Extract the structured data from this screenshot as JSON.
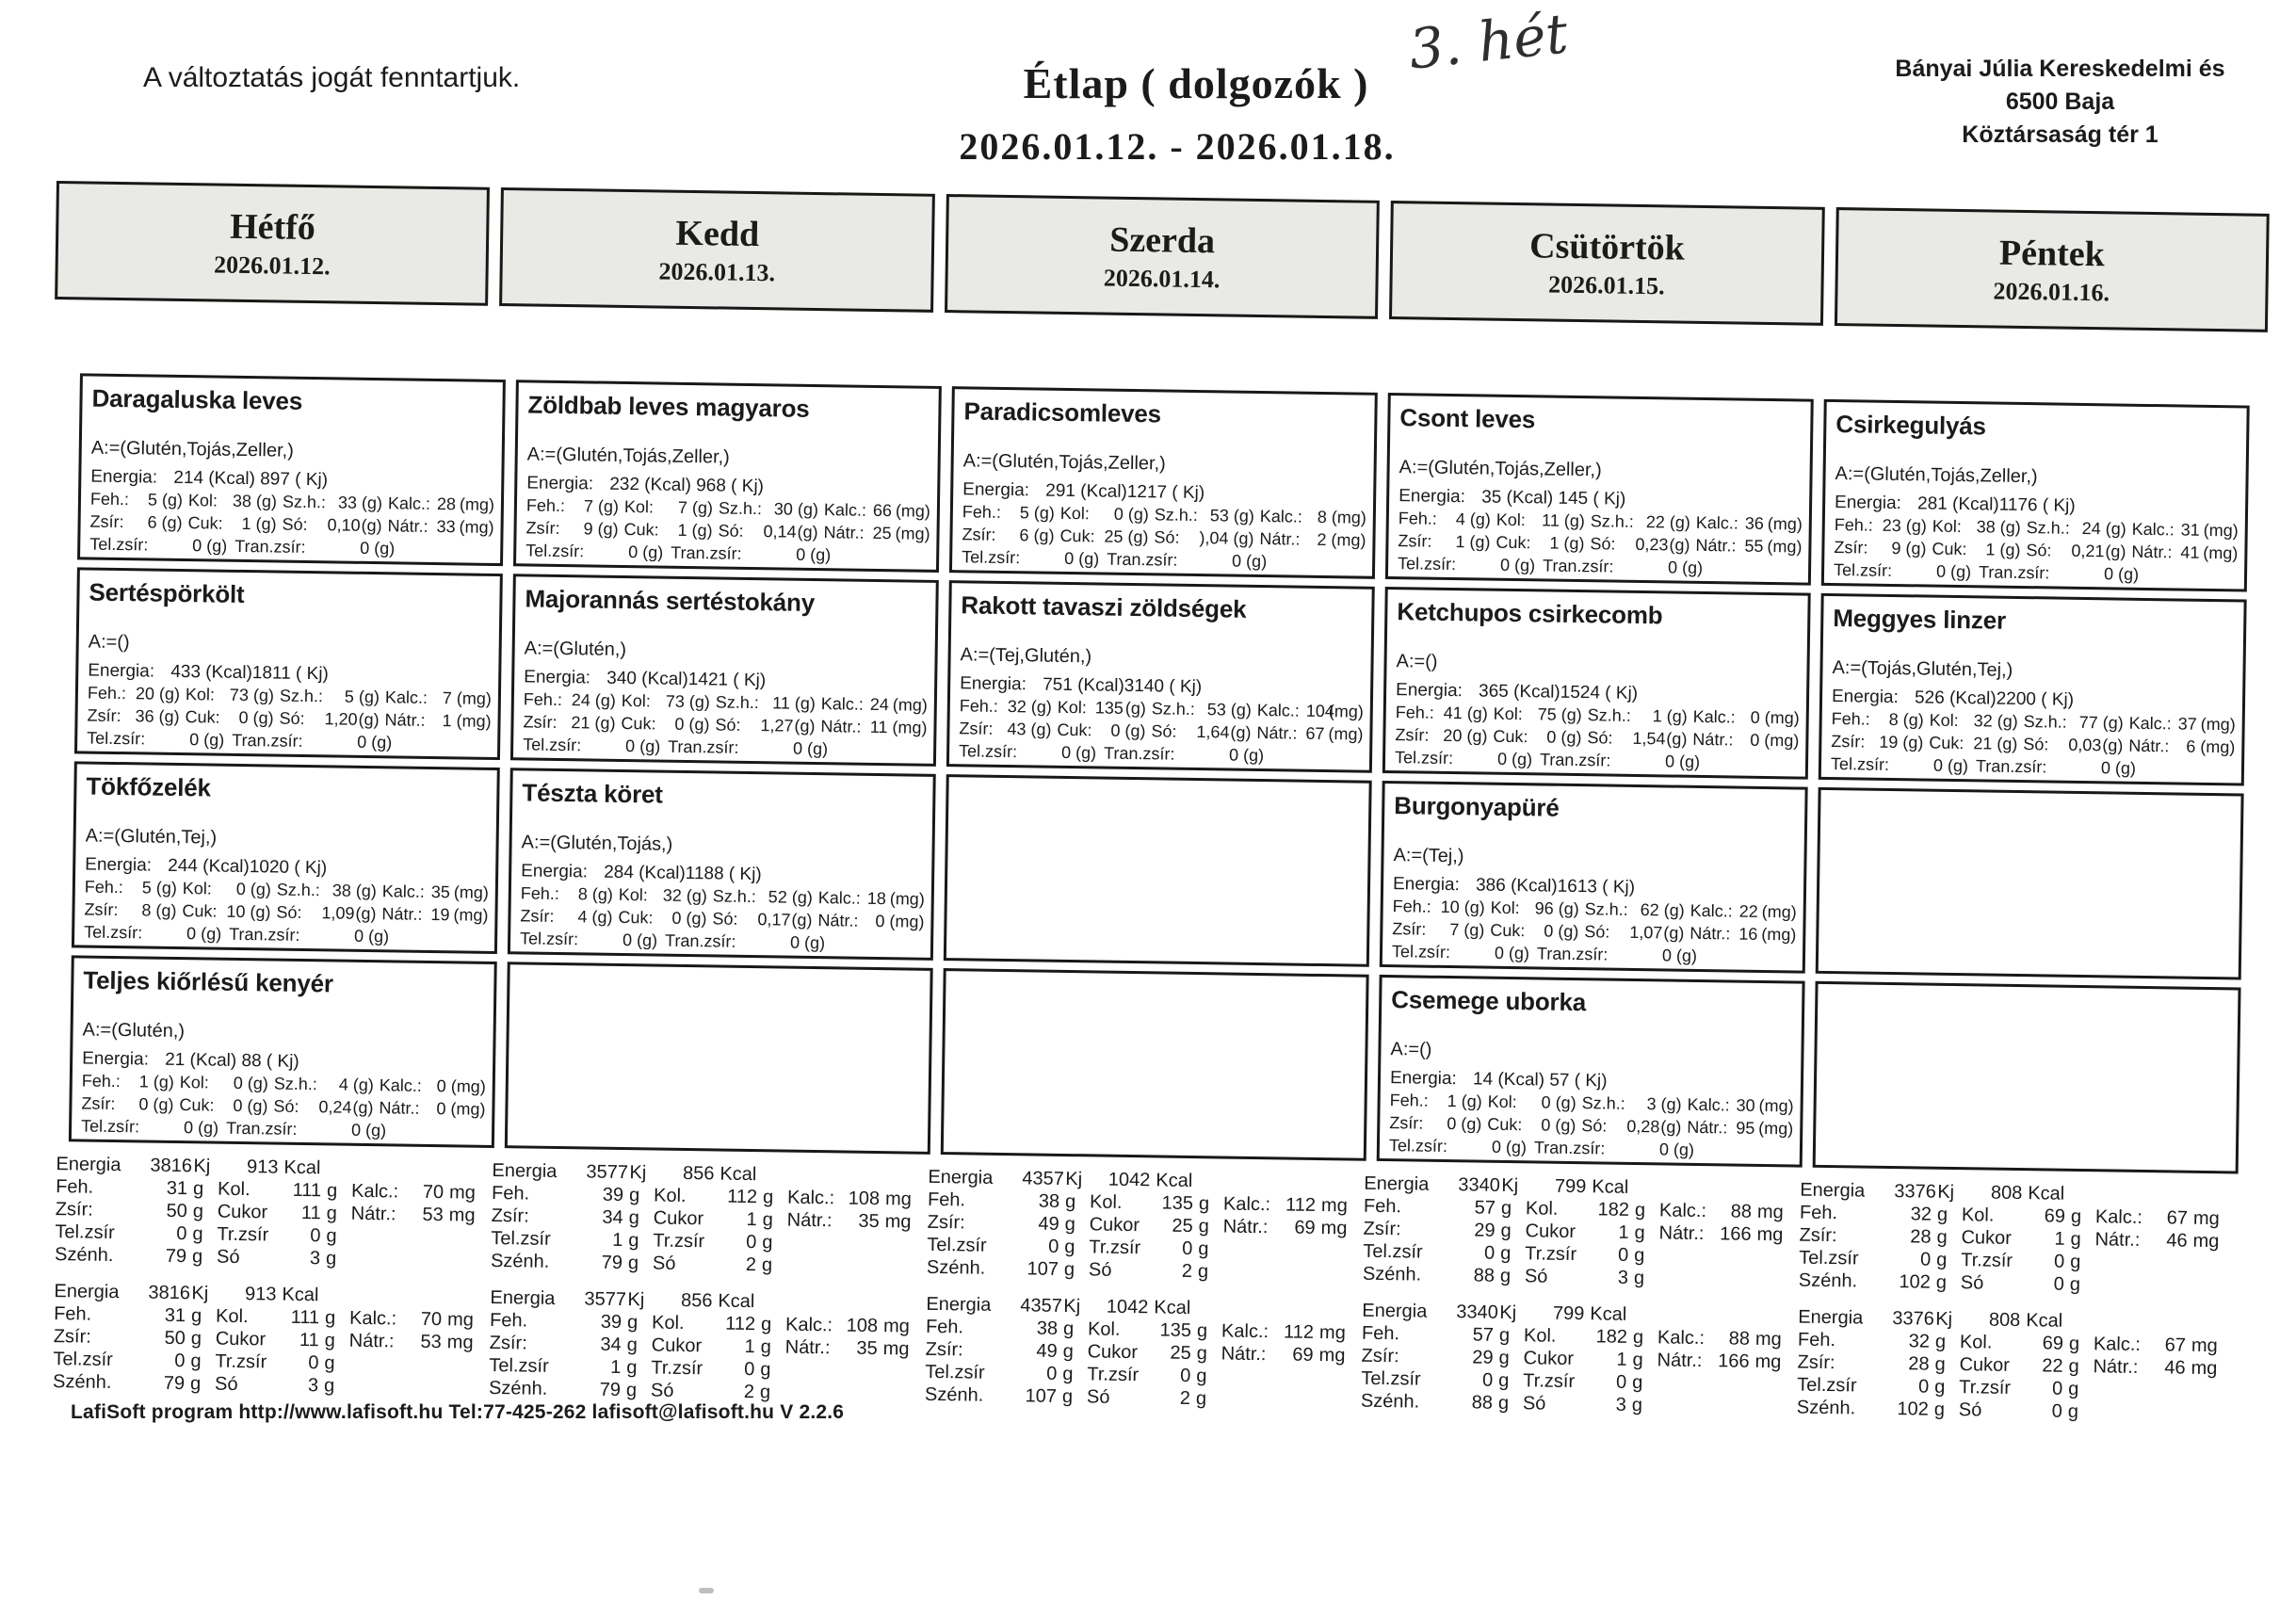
{
  "header": {
    "disclaimer": "A változtatás jogát fenntartjuk.",
    "title": "Étlap ( dolgozók )",
    "date_range": "2026.01.12. - 2026.01.18.",
    "handwritten_note": "3. hét",
    "company_line1": "Bányai Júlia Kereskedelmi és",
    "company_line2": "6500 Baja",
    "company_line3": "Köztársaság tér 1"
  },
  "labels": {
    "card": {
      "energia": "Energia:",
      "feh": "Feh.:",
      "kol": "Kol:",
      "szh": "Sz.h.:",
      "kalc": "Kalc.:",
      "zsir": "Zsír:",
      "cuk": "Cuk:",
      "so": "Só:",
      "natr": "Nátr.:",
      "telzsir": "Tel.zsír:",
      "tranzsir": "Tran.zsír:",
      "g": "(g)",
      "mg": "(mg)"
    },
    "summary": {
      "energia": "Energia",
      "kj": "Kj",
      "kcal": "Kcal",
      "feh": "Feh.",
      "kol": "Kol.",
      "kalc": "Kalc.:",
      "zsir": "Zsír:",
      "cukor": "Cukor",
      "natr": "Nátr.:",
      "telzsir": "Tel.zsír",
      "trzsir": "Tr.zsír",
      "szenh": "Szénh.",
      "so": "Só",
      "g": "g",
      "mg": "mg"
    }
  },
  "days": [
    {
      "name": "Hétfő",
      "date": "2026.01.12.",
      "meals": [
        {
          "title": "Daragaluska leves",
          "allergens": "A:=(Glutén,Tojás,Zeller,)",
          "energia": "214 (Kcal) 897 ( Kj)",
          "feh": "5",
          "kol": "38",
          "szh": "33",
          "kalc": "28",
          "zsir": "6",
          "cuk": "1",
          "so": "0,10",
          "natr": "33",
          "telzsir": "0",
          "tranzsir": "0"
        },
        {
          "title": "Sertéspörkölt",
          "allergens": "A:=()",
          "energia": "433 (Kcal)1811 ( Kj)",
          "feh": "20",
          "kol": "73",
          "szh": "5",
          "kalc": "7",
          "zsir": "36",
          "cuk": "0",
          "so": "1,20",
          "natr": "1",
          "telzsir": "0",
          "tranzsir": "0"
        },
        {
          "title": "Tökfőzelék",
          "allergens": "A:=(Glutén,Tej,)",
          "energia": "244 (Kcal)1020 ( Kj)",
          "feh": "5",
          "kol": "0",
          "szh": "38",
          "kalc": "35",
          "zsir": "8",
          "cuk": "10",
          "so": "1,09",
          "natr": "19",
          "telzsir": "0",
          "tranzsir": "0"
        },
        {
          "title": "Teljes kiőrlésű kenyér",
          "allergens": "A:=(Glutén,)",
          "energia": "21 (Kcal)  88 ( Kj)",
          "feh": "1",
          "kol": "0",
          "szh": "4",
          "kalc": "0",
          "zsir": "0",
          "cuk": "0",
          "so": "0,24",
          "natr": "0",
          "telzsir": "0",
          "tranzsir": "0"
        }
      ],
      "summaries": [
        {
          "kj": "3816",
          "kcal": "913",
          "feh": "31",
          "kol": "111",
          "kalc": "70",
          "zsir": "50",
          "cukor": "11",
          "natr": "53",
          "telzsir": "0",
          "trzsir": "0",
          "szenh": "79",
          "so": "3"
        },
        {
          "kj": "3816",
          "kcal": "913",
          "feh": "31",
          "kol": "111",
          "kalc": "70",
          "zsir": "50",
          "cukor": "11",
          "natr": "53",
          "telzsir": "0",
          "trzsir": "0",
          "szenh": "79",
          "so": "3"
        }
      ]
    },
    {
      "name": "Kedd",
      "date": "2026.01.13.",
      "meals": [
        {
          "title": "Zöldbab leves magyaros",
          "allergens": "A:=(Glutén,Tojás,Zeller,)",
          "energia": "232 (Kcal) 968 ( Kj)",
          "feh": "7",
          "kol": "7",
          "szh": "30",
          "kalc": "66",
          "zsir": "9",
          "cuk": "1",
          "so": "0,14",
          "natr": "25",
          "telzsir": "0",
          "tranzsir": "0"
        },
        {
          "title": "Majorannás sertéstokány",
          "allergens": "A:=(Glutén,)",
          "energia": "340 (Kcal)1421 ( Kj)",
          "feh": "24",
          "kol": "73",
          "szh": "11",
          "kalc": "24",
          "zsir": "21",
          "cuk": "0",
          "so": "1,27",
          "natr": "11",
          "telzsir": "0",
          "tranzsir": "0"
        },
        {
          "title": "Tészta köret",
          "allergens": "A:=(Glutén,Tojás,)",
          "energia": "284 (Kcal)1188 ( Kj)",
          "feh": "8",
          "kol": "32",
          "szh": "52",
          "kalc": "18",
          "zsir": "4",
          "cuk": "0",
          "so": "0,17",
          "natr": "0",
          "telzsir": "0",
          "tranzsir": "0"
        },
        null
      ],
      "summaries": [
        {
          "kj": "3577",
          "kcal": "856",
          "feh": "39",
          "kol": "112",
          "kalc": "108",
          "zsir": "34",
          "cukor": "1",
          "natr": "35",
          "telzsir": "1",
          "trzsir": "0",
          "szenh": "79",
          "so": "2"
        },
        {
          "kj": "3577",
          "kcal": "856",
          "feh": "39",
          "kol": "112",
          "kalc": "108",
          "zsir": "34",
          "cukor": "1",
          "natr": "35",
          "telzsir": "1",
          "trzsir": "0",
          "szenh": "79",
          "so": "2"
        }
      ]
    },
    {
      "name": "Szerda",
      "date": "2026.01.14.",
      "meals": [
        {
          "title": "Paradicsomleves",
          "allergens": "A:=(Glutén,Tojás,Zeller,)",
          "energia": "291 (Kcal)1217 ( Kj)",
          "feh": "5",
          "kol": "0",
          "szh": "53",
          "kalc": "8",
          "zsir": "6",
          "cuk": "25",
          "so": "),04",
          "natr": "2",
          "telzsir": "0",
          "tranzsir": "0"
        },
        {
          "title": "Rakott tavaszi zöldségek",
          "allergens": "A:=(Tej,Glutén,)",
          "energia": "751 (Kcal)3140 ( Kj)",
          "feh": "32",
          "kol": "135",
          "szh": "53",
          "kalc": "104",
          "zsir": "43",
          "cuk": "0",
          "so": "1,64",
          "natr": "67",
          "telzsir": "0",
          "tranzsir": "0"
        },
        null,
        null
      ],
      "summaries": [
        {
          "kj": "4357",
          "kcal": "1042",
          "feh": "38",
          "kol": "135",
          "kalc": "112",
          "zsir": "49",
          "cukor": "25",
          "natr": "69",
          "telzsir": "0",
          "trzsir": "0",
          "szenh": "107",
          "so": "2"
        },
        {
          "kj": "4357",
          "kcal": "1042",
          "feh": "38",
          "kol": "135",
          "kalc": "112",
          "zsir": "49",
          "cukor": "25",
          "natr": "69",
          "telzsir": "0",
          "trzsir": "0",
          "szenh": "107",
          "so": "2"
        }
      ]
    },
    {
      "name": "Csütörtök",
      "date": "2026.01.15.",
      "meals": [
        {
          "title": "Csont leves",
          "allergens": "A:=(Glutén,Tojás,Zeller,)",
          "energia": "35 (Kcal) 145 ( Kj)",
          "feh": "4",
          "kol": "11",
          "szh": "22",
          "kalc": "36",
          "zsir": "1",
          "cuk": "1",
          "so": "0,23",
          "natr": "55",
          "telzsir": "0",
          "tranzsir": "0"
        },
        {
          "title": "Ketchupos csirkecomb",
          "allergens": "A:=()",
          "energia": "365 (Kcal)1524 ( Kj)",
          "feh": "41",
          "kol": "75",
          "szh": "1",
          "kalc": "0",
          "zsir": "20",
          "cuk": "0",
          "so": "1,54",
          "natr": "0",
          "telzsir": "0",
          "tranzsir": "0"
        },
        {
          "title": "Burgonyapüré",
          "allergens": "A:=(Tej,)",
          "energia": "386 (Kcal)1613 ( Kj)",
          "feh": "10",
          "kol": "96",
          "szh": "62",
          "kalc": "22",
          "zsir": "7",
          "cuk": "0",
          "so": "1,07",
          "natr": "16",
          "telzsir": "0",
          "tranzsir": "0"
        },
        {
          "title": "Csemege uborka",
          "allergens": "A:=()",
          "energia": "14 (Kcal)  57 ( Kj)",
          "feh": "1",
          "kol": "0",
          "szh": "3",
          "kalc": "30",
          "zsir": "0",
          "cuk": "0",
          "so": "0,28",
          "natr": "95",
          "telzsir": "0",
          "tranzsir": "0"
        }
      ],
      "summaries": [
        {
          "kj": "3340",
          "kcal": "799",
          "feh": "57",
          "kol": "182",
          "kalc": "88",
          "zsir": "29",
          "cukor": "1",
          "natr": "166",
          "telzsir": "0",
          "trzsir": "0",
          "szenh": "88",
          "so": "3"
        },
        {
          "kj": "3340",
          "kcal": "799",
          "feh": "57",
          "kol": "182",
          "kalc": "88",
          "zsir": "29",
          "cukor": "1",
          "natr": "166",
          "telzsir": "0",
          "trzsir": "0",
          "szenh": "88",
          "so": "3"
        }
      ]
    },
    {
      "name": "Péntek",
      "date": "2026.01.16.",
      "meals": [
        {
          "title": "Csirkegulyás",
          "allergens": "A:=(Glutén,Tojás,Zeller,)",
          "energia": "281 (Kcal)1176 ( Kj)",
          "feh": "23",
          "kol": "38",
          "szh": "24",
          "kalc": "31",
          "zsir": "9",
          "cuk": "1",
          "so": "0,21",
          "natr": "41",
          "telzsir": "0",
          "tranzsir": "0"
        },
        {
          "title": "Meggyes linzer",
          "allergens": "A:=(Tojás,Glutén,Tej,)",
          "energia": "526 (Kcal)2200 ( Kj)",
          "feh": "8",
          "kol": "32",
          "szh": "77",
          "kalc": "37",
          "zsir": "19",
          "cuk": "21",
          "so": "0,03",
          "natr": "6",
          "telzsir": "0",
          "tranzsir": "0"
        },
        null,
        null
      ],
      "summaries": [
        {
          "kj": "3376",
          "kcal": "808",
          "feh": "32",
          "kol": "69",
          "kalc": "67",
          "zsir": "28",
          "cukor": "1",
          "natr": "46",
          "telzsir": "0",
          "trzsir": "0",
          "szenh": "102",
          "so": "0"
        },
        {
          "kj": "3376",
          "kcal": "808",
          "feh": "32",
          "kol": "69",
          "kalc": "67",
          "zsir": "28",
          "cukor": "22",
          "natr": "46",
          "telzsir": "0",
          "trzsir": "0",
          "szenh": "102",
          "so": "0"
        }
      ]
    }
  ],
  "footer": "LafiSoft program  http://www.lafisoft.hu Tel:77-425-262  lafisoft@lafisoft.hu  V 2.2.6"
}
